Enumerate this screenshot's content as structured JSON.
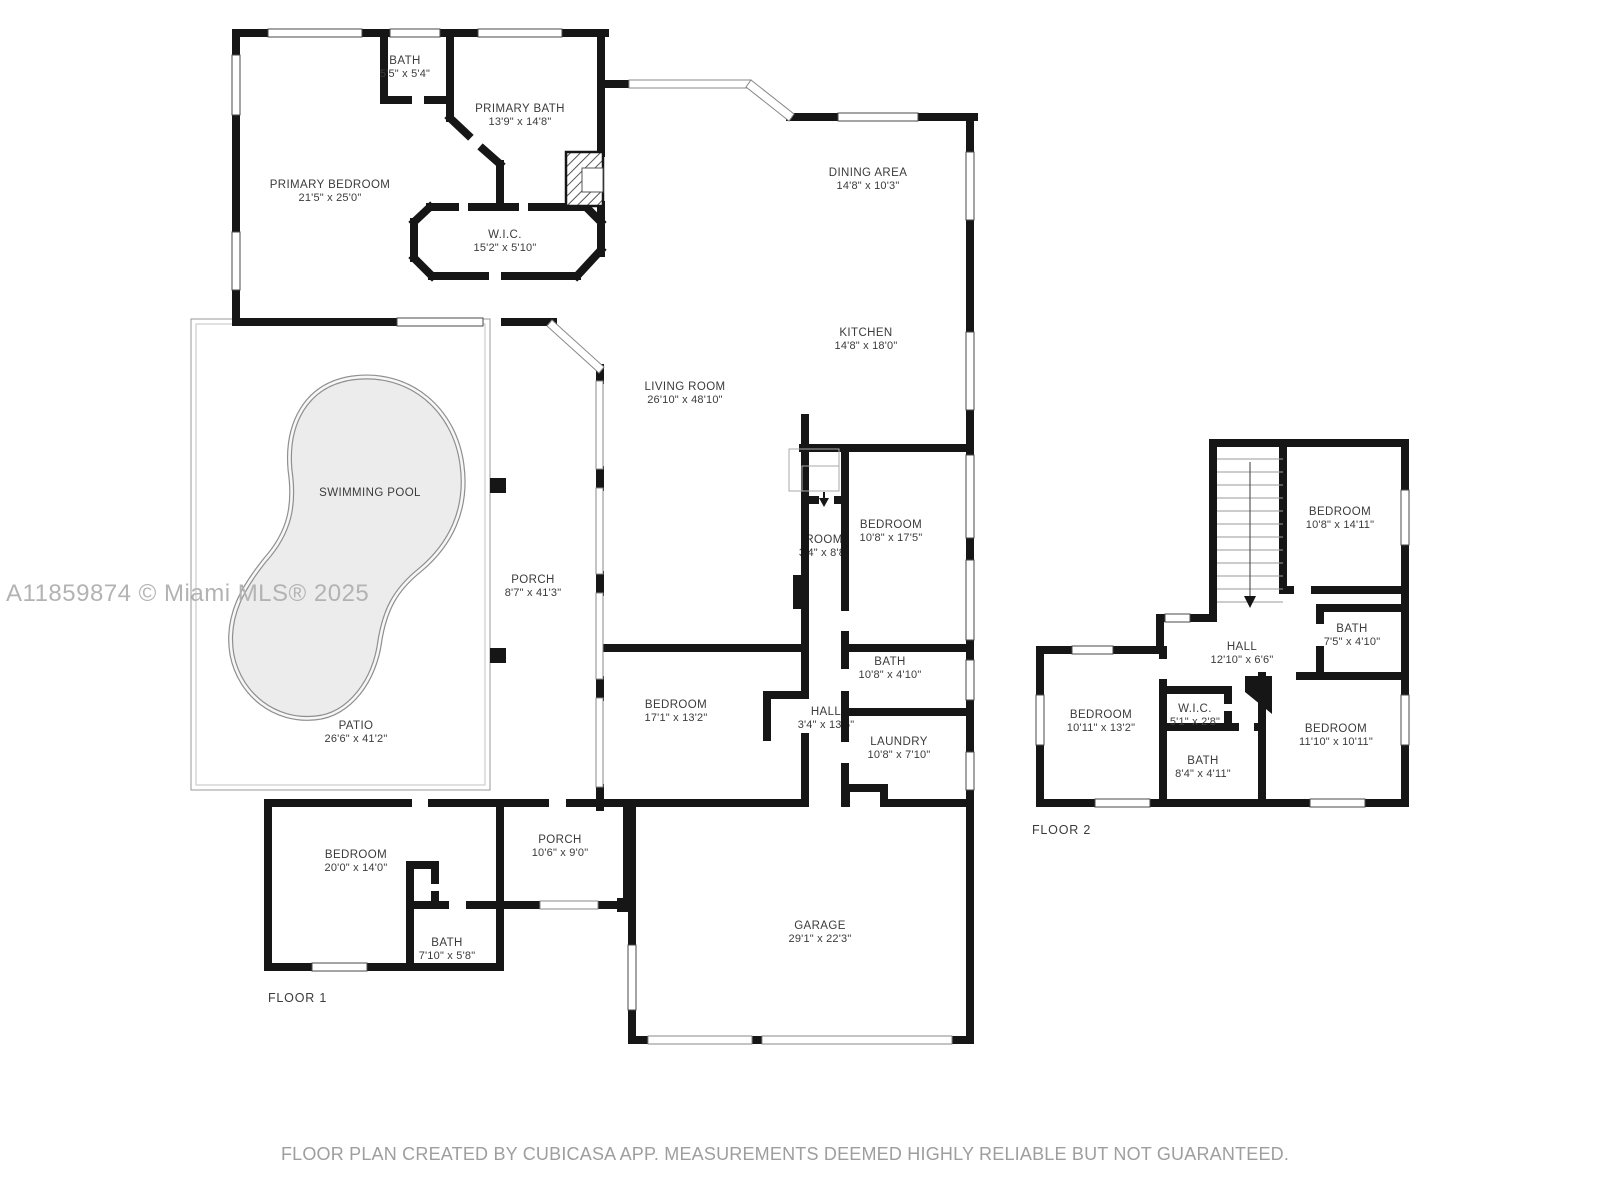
{
  "watermark": "A11859874 © Miami MLS® 2025",
  "footer": "FLOOR PLAN CREATED BY CUBICASA APP. MEASUREMENTS DEEMED HIGHLY RELIABLE BUT NOT GUARANTEED.",
  "colors": {
    "wall": "#161616",
    "room_text": "#3b3b3b",
    "watermark_text": "#b3b3b3",
    "footer_text": "#9e9e9e",
    "pool_fill": "#ececec",
    "pool_outline": "#8f8f8f",
    "patio_outline": "#999999"
  },
  "floor1": {
    "label": "FLOOR 1",
    "rooms": [
      {
        "name": "BATH",
        "dims": "5'5\" x 5'4\""
      },
      {
        "name": "PRIMARY BATH",
        "dims": "13'9\" x 14'8\""
      },
      {
        "name": "PRIMARY BEDROOM",
        "dims": "21'5\" x 25'0\""
      },
      {
        "name": "W.I.C.",
        "dims": "15'2\" x 5'10\""
      },
      {
        "name": "DINING AREA",
        "dims": "14'8\" x 10'3\""
      },
      {
        "name": "KITCHEN",
        "dims": "14'8\" x 18'0\""
      },
      {
        "name": "LIVING ROOM",
        "dims": "26'10\" x 48'10\""
      },
      {
        "name": "SWIMMING POOL",
        "dims": ""
      },
      {
        "name": "PORCH",
        "dims": "8'7\" x 41'3\""
      },
      {
        "name": "PATIO",
        "dims": "26'6\" x 41'2\""
      },
      {
        "name": "ROOM",
        "dims": "3'4\" x 8'8\""
      },
      {
        "name": "BEDROOM",
        "dims": "10'8\" x 17'5\""
      },
      {
        "name": "BATH",
        "dims": "10'8\" x 4'10\""
      },
      {
        "name": "HALL",
        "dims": "3'4\" x 13'6\""
      },
      {
        "name": "LAUNDRY",
        "dims": "10'8\" x 7'10\""
      },
      {
        "name": "BEDROOM",
        "dims": "17'1\" x 13'2\""
      },
      {
        "name": "BEDROOM",
        "dims": "20'0\" x 14'0\""
      },
      {
        "name": "BATH",
        "dims": "7'10\" x 5'8\""
      },
      {
        "name": "PORCH",
        "dims": "10'6\" x 9'0\""
      },
      {
        "name": "GARAGE",
        "dims": "29'1\" x 22'3\""
      }
    ]
  },
  "floor2": {
    "label": "FLOOR 2",
    "rooms": [
      {
        "name": "BEDROOM",
        "dims": "10'8\" x 14'11\""
      },
      {
        "name": "BATH",
        "dims": "7'5\" x 4'10\""
      },
      {
        "name": "HALL",
        "dims": "12'10\" x 6'6\""
      },
      {
        "name": "BEDROOM",
        "dims": "10'11\" x 13'2\""
      },
      {
        "name": "W.I.C.",
        "dims": "5'1\" x 2'8\""
      },
      {
        "name": "BATH",
        "dims": "8'4\" x 4'11\""
      },
      {
        "name": "BEDROOM",
        "dims": "11'10\" x 10'11\""
      }
    ]
  }
}
